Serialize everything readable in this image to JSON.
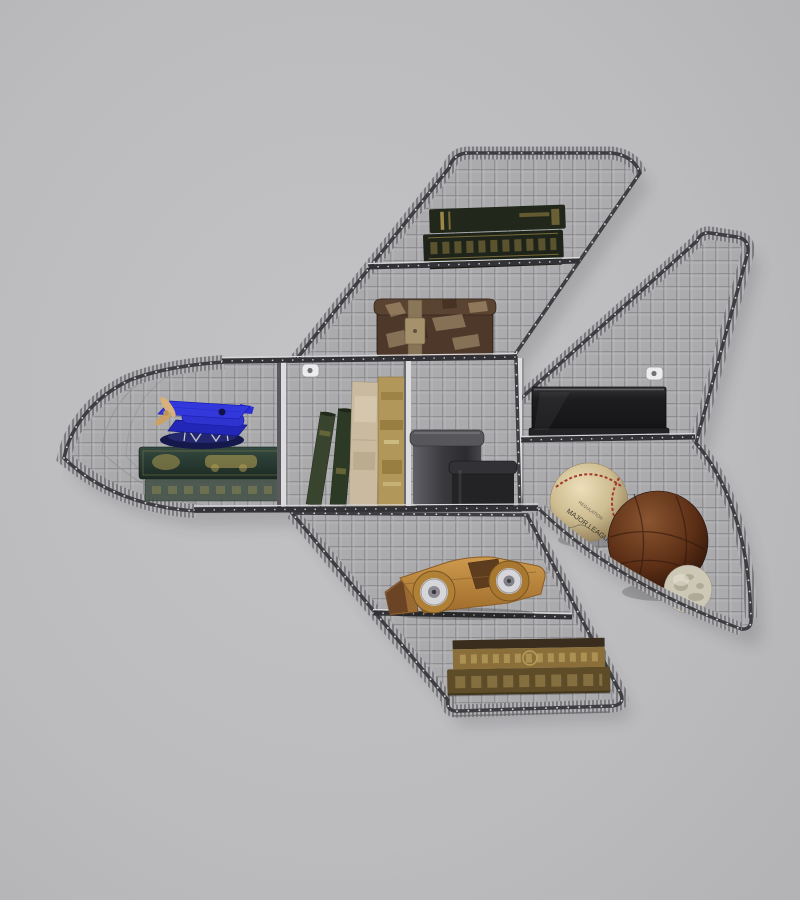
{
  "image": {
    "subject": "Airplane-shaped wire mesh wall shelf with vintage collectibles",
    "setting": "photographed on a plain gray wall"
  },
  "wall": {
    "color": "#bdbdbf"
  },
  "shelf": {
    "frame_color": "#3e3e42",
    "mesh_fill": "#ababae",
    "mesh_line": "#8e8e91",
    "mesh_line_light": "#bfbfc2",
    "rib_fill": "#a7a7aa",
    "rib_line": "#6e6e72",
    "divider_color": "#dcdcde",
    "rivet_color": "#ededef",
    "rail_color": "#323236",
    "rail_highlight": "#d8d8da"
  },
  "objects": {
    "top_wing_books": {
      "name": "pair of antique books with gold tooling",
      "cover": "#22271b",
      "gold": "#b49a4e"
    },
    "storage_box": {
      "name": "distressed vintage trunk box",
      "color": "#4e382a",
      "scuff": "#cdb68d"
    },
    "toy_biplane": {
      "name": "blue toy biplane",
      "body": "#2e33cf",
      "wing": "#3338dd",
      "propeller": "#d8b079"
    },
    "nose_book": {
      "name": "green antique book with gilt automobile",
      "cover": "#2c423a",
      "gold": "#b8a254"
    },
    "leaning_books": {
      "name": "two slim green books",
      "colors": [
        "#39442e",
        "#2c3a25"
      ]
    },
    "standing_books": {
      "name": "two tall worn books",
      "colors": [
        "#c9baa0",
        "#b2975a"
      ]
    },
    "canisters": {
      "name": "two metal canisters",
      "large": "#46464a",
      "small": "#232325",
      "small_rim": "#323236"
    },
    "black_box": {
      "name": "black metal document box",
      "color": "#222225"
    },
    "baseball": {
      "name": "vintage baseball",
      "leather": "#d9cba6",
      "stitch": "#a23a30",
      "text_line1": "REGULATION",
      "text_line2": "MAJOR LEAGUE"
    },
    "leather_ball": {
      "name": "brown leather medicine ball",
      "color": "#6a3d22"
    },
    "stone_ball": {
      "name": "small mottled stone ball",
      "color": "#cdc7b6"
    },
    "toy_car": {
      "name": "wooden toy race car",
      "wood": "#bd8a41",
      "wheel": "#d6d6da"
    },
    "bottom_wing_books": {
      "name": "two gilded antique books",
      "spine": "#8a6f3a",
      "cover": "#3a2d1d",
      "lower": "#5e4c28"
    }
  }
}
